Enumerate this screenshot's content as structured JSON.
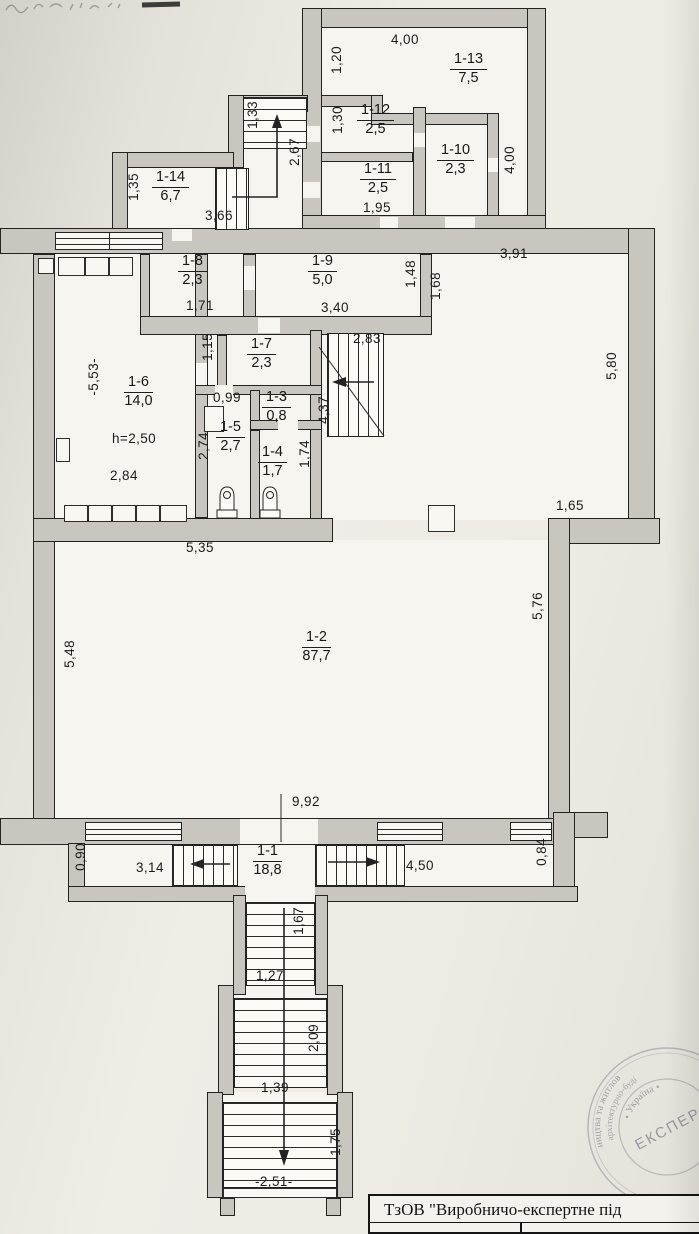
{
  "rooms": [
    {
      "id": "1-1",
      "area": "18,8"
    },
    {
      "id": "1-2",
      "area": "87,7"
    },
    {
      "id": "1-3",
      "area": "0,8"
    },
    {
      "id": "1-4",
      "area": "1,7"
    },
    {
      "id": "1-5",
      "area": "2,7"
    },
    {
      "id": "1-6",
      "area": "14,0"
    },
    {
      "id": "1-7",
      "area": "2,3"
    },
    {
      "id": "1-8",
      "area": "2,3"
    },
    {
      "id": "1-9",
      "area": "5,0"
    },
    {
      "id": "1-10",
      "area": "2,3"
    },
    {
      "id": "1-11",
      "area": "2,5"
    },
    {
      "id": "1-12",
      "area": "2,5"
    },
    {
      "id": "1-13",
      "area": "7,5"
    },
    {
      "id": "1-14",
      "area": "6,7"
    }
  ],
  "dims": [
    "4,00",
    "1,20",
    "4,00",
    "1,30",
    "1,95",
    "1,33",
    "2,67",
    "1,35",
    "3,66",
    "3,91",
    "1,71",
    "3,40",
    "1,48",
    "1,68",
    "2,83",
    "1,15",
    "4,37",
    "0,99",
    "-5,53-",
    "h=2,50",
    "2,84",
    "2,74",
    "1,74",
    "5,80",
    "1,65",
    "5,35",
    "5,48",
    "5,76",
    "9,92",
    "0,90",
    "3,14",
    "4,50",
    "0,84",
    "1,67",
    "1,27",
    "2,09",
    "1,39",
    "1,75",
    "-2,51-"
  ],
  "stamp": {
    "org": "ТзОВ \"Виробничо-експертне під"
  },
  "seal": {
    "arc_outer": "ництва та житлов",
    "arc_mid": "архітектурно-буді",
    "arc_inner": "• Україна •",
    "center": "ЕКСПЕР"
  }
}
